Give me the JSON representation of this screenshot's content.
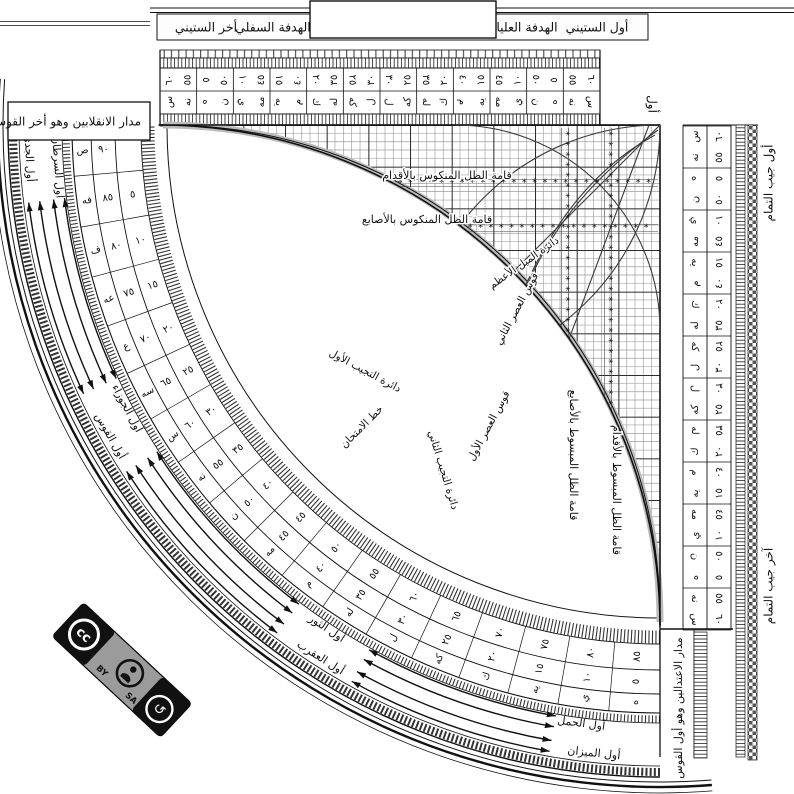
{
  "instrument": "sine-quadrant",
  "top_bar": {
    "first_sixty": "أول الستيني",
    "upper_sight": "الهدفة العليا",
    "lower_sight": "الهدفة السفلي",
    "last_sixty": "أخر الستيني",
    "start_word": "أول"
  },
  "corner_labels": {
    "solstice_box": "مدار الانقلابين وهو أخر القوس",
    "equinox_strip": "مدار الاعتدالين وهو أول القوس",
    "cosine_start": "أول جيب التمام",
    "cosine_end": "آخر جيب التمام"
  },
  "grid_labels": {
    "foot_reversed": "قامة الظل المنكوس بالأقدام",
    "digit_reversed": "قامة الظل المنكوس بالأصابع",
    "digit_extended": "قامة الظل المبسوط بالأصابع",
    "foot_extended": "قامة الظل المبسوط بالأقدام",
    "max_declination": "دائرة الميل الأعظم",
    "asr_second": "قوس العصر الثاني",
    "asr_first": "قوس العصر الأول",
    "sine_first": "دائرة التجيب الأول",
    "sine_second": "دائرة التجيب الثاني",
    "test_line": "خط الامتحان"
  },
  "zodiac": [
    {
      "label": "أول الجدي",
      "angle": 177,
      "ring": 1
    },
    {
      "label": "أول السرطان",
      "angle": 176,
      "ring": 0
    },
    {
      "label": "أول الجوزاء",
      "angle": 152,
      "ring": 0
    },
    {
      "label": "أول القوس",
      "angle": 150.5,
      "ring": 1
    },
    {
      "label": "أول الثور",
      "angle": 123.5,
      "ring": 0
    },
    {
      "label": "أول العقرب",
      "angle": 122.5,
      "ring": 1
    },
    {
      "label": "أول الحمل",
      "angle": 97.5,
      "ring": 0
    },
    {
      "label": "أول الميزان",
      "angle": 96,
      "ring": 1
    }
  ],
  "sexagesimal_rows": [
    {
      "v": "٦٠",
      "a": "س",
      "f": false
    },
    {
      "v": "٥٥",
      "a": "نه",
      "f": false
    },
    {
      "v": "٥",
      "a": "ه",
      "f": true
    },
    {
      "v": "٥٠",
      "a": "ن",
      "f": false
    },
    {
      "v": "١٠",
      "a": "ي",
      "f": true
    },
    {
      "v": "٤٥",
      "a": "مه",
      "f": false
    },
    {
      "v": "١٥",
      "a": "يه",
      "f": true
    },
    {
      "v": "٤٠",
      "a": "م",
      "f": false
    },
    {
      "v": "٢٠",
      "a": "ك",
      "f": true
    },
    {
      "v": "٣٥",
      "a": "له",
      "f": false
    },
    {
      "v": "٢٥",
      "a": "كه",
      "f": true
    },
    {
      "v": "٣٠",
      "a": "ل",
      "f": false
    },
    {
      "v": "٣٠",
      "a": "ل",
      "f": true
    },
    {
      "v": "٢٥",
      "a": "كه",
      "f": false
    },
    {
      "v": "٣٥",
      "a": "له",
      "f": true
    },
    {
      "v": "٢٠",
      "a": "ك",
      "f": false
    },
    {
      "v": "٤٠",
      "a": "م",
      "f": true
    },
    {
      "v": "١٥",
      "a": "يه",
      "f": false
    },
    {
      "v": "٤٥",
      "a": "مه",
      "f": true
    },
    {
      "v": "١٠",
      "a": "ي",
      "f": false
    },
    {
      "v": "٥٠",
      "a": "ن",
      "f": true
    },
    {
      "v": "٥",
      "a": "ه",
      "f": false
    },
    {
      "v": "٥٥",
      "a": "نه",
      "f": true
    },
    {
      "v": "٦٠",
      "a": "س",
      "f": true
    }
  ],
  "arc_scale": {
    "outer": [
      "٩٠",
      "٨٥",
      "٨٠",
      "٧٥",
      "٧٠",
      "٦٥",
      "٦٠",
      "٥٥",
      "٥٠",
      "٤٥",
      "٤٠",
      "٣٥",
      "٣٠",
      "٢٥",
      "٢٠",
      "١٥",
      "١٠",
      "٥"
    ],
    "abjad": [
      "ص",
      "فه",
      "ف",
      "عه",
      "ع",
      "سه",
      "س",
      "نه",
      "ن",
      "مه",
      "م",
      "له",
      "ل",
      "كه",
      "ك",
      "يه",
      "ي",
      "ه"
    ],
    "inner": [
      "",
      "٥",
      "١٠",
      "١٥",
      "٢٠",
      "٢٥",
      "٣٠",
      "٣٥",
      "٤٠",
      "٤٥",
      "٥٠",
      "٥٥",
      "٦٠",
      "٦٥",
      "٧٠",
      "٧٥",
      "٨٠",
      "٨٥"
    ]
  },
  "license": {
    "cc": "cc",
    "by": "BY",
    "sa": "SA"
  },
  "colors": {
    "ink": "#111111",
    "grid_minor": "#8c8c8c",
    "band_gray": "#bbbbbb",
    "badge_gray": "#9b9b9b"
  }
}
